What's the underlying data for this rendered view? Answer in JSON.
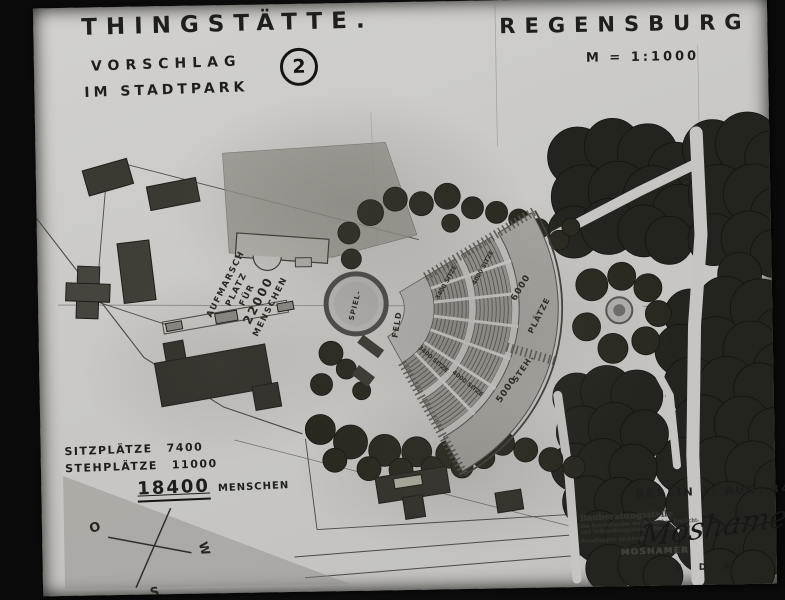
{
  "titles": {
    "main": "THINGSTÄTTE.",
    "proposal": "VORSCHLAG",
    "location": "IM STADTPARK",
    "sheet_number": "2",
    "city": "REGENSBURG",
    "scale": "M = 1:1000"
  },
  "plan": {
    "parade_lines": [
      "AUFMARSCH",
      "PLATZ",
      "FÜR",
      "22000",
      "MENSCHEN"
    ],
    "stage_circle_label": "SPIEL-",
    "field_label": "FELD",
    "tier_inner_label": "3400 SITZE",
    "tier_outer_label": "4000 SITZE",
    "promenade_upper_count": "6000",
    "promenade_upper_word": "PLÄTZE",
    "promenade_lower_count": "5000",
    "promenade_lower_word": "STEH."
  },
  "capacity": {
    "seats_label": "SITZPLÄTZE",
    "seats_value": "7400",
    "standing_label": "STEHPLÄTZE",
    "standing_value": "11000",
    "total_value": "18400",
    "total_label": "MENSCHEN"
  },
  "compass": {
    "east": "O",
    "west": "W",
    "south": "S"
  },
  "stamp": {
    "date": "BERLIN 1. AUG. 34",
    "org_line1": "Bauberatungsstelle",
    "org_line2": "des Reichsbundes der deutschen Freilicht-",
    "org_line3": "und Volksschauspiele e.V. Bln.-Südende",
    "role_line": "Beauftragter Architekt:",
    "stamped_name": "MOSHAMER",
    "signature": "Moshamer",
    "credentials": "B D A"
  },
  "colors": {
    "photo_bg": "#0b0b0b",
    "paper": "#c9c8c4",
    "ink": "#1c1c1a",
    "pencil": "#3c3b36",
    "foliage": "#24241e"
  }
}
